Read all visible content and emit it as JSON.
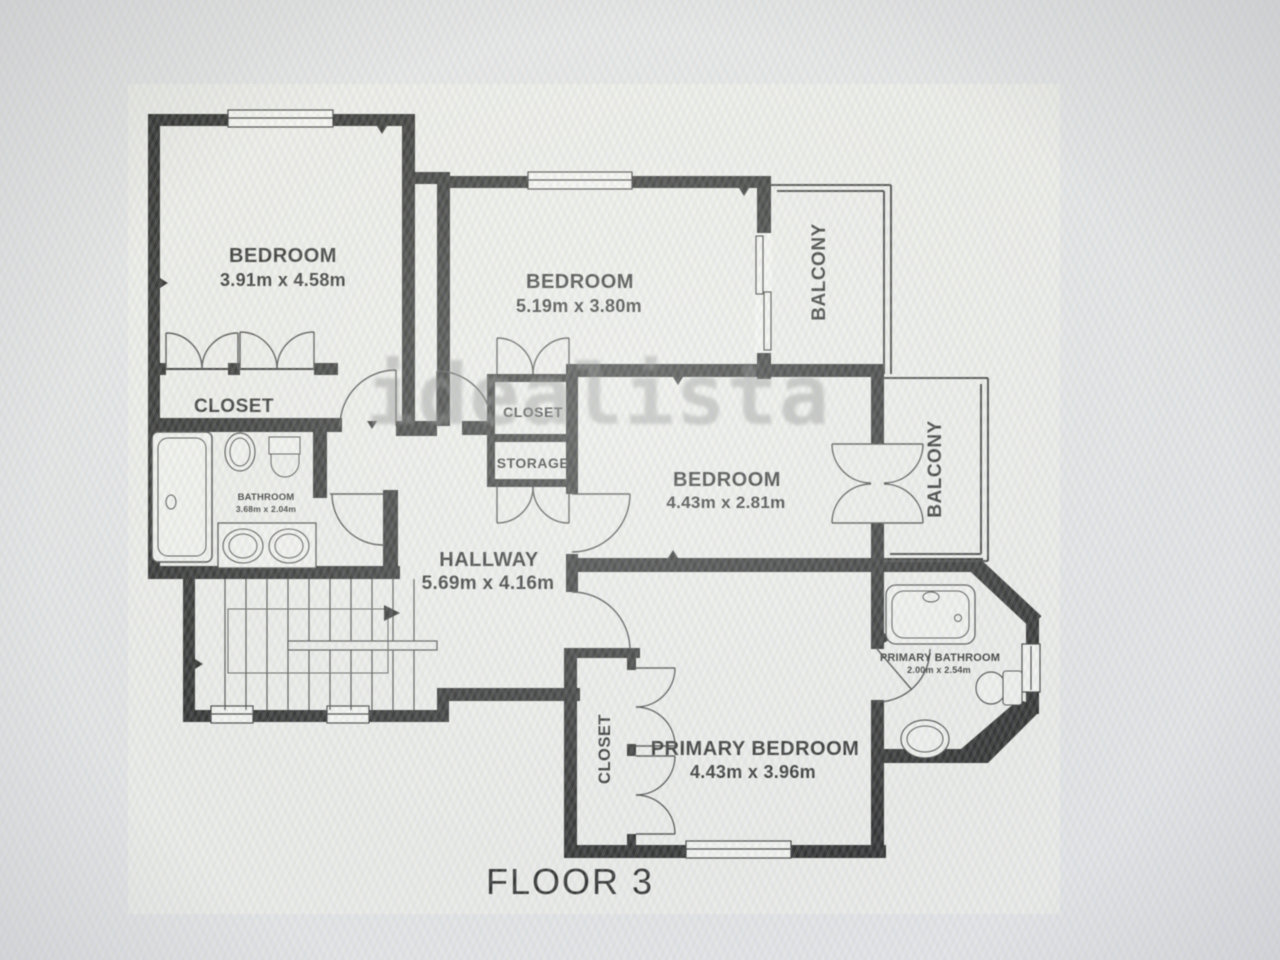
{
  "floor_label": "FLOOR 3",
  "watermark": "idealista",
  "rooms": {
    "bedroom_top_left": {
      "label": "BEDROOM",
      "dimensions": "3.91m x 4.58m"
    },
    "bedroom_top_middle": {
      "label": "BEDROOM",
      "dimensions": "5.19m x 3.80m"
    },
    "bedroom_middle_right": {
      "label": "BEDROOM",
      "dimensions": "4.43m x 2.81m"
    },
    "primary_bedroom": {
      "label": "PRIMARY BEDROOM",
      "dimensions": "4.43m x 3.96m"
    },
    "hallway": {
      "label": "HALLWAY",
      "dimensions": "5.69m x 4.16m"
    },
    "bathroom": {
      "label": "BATHROOM",
      "dimensions": "3.68m x 2.04m"
    },
    "primary_bathroom": {
      "label": "PRIMARY BATHROOM",
      "dimensions": "2.00m x 2.54m"
    },
    "closet_left": {
      "label": "CLOSET"
    },
    "closet_middle": {
      "label": "CLOSET"
    },
    "storage": {
      "label": "STORAGE"
    },
    "closet_primary": {
      "label": "CLOSET"
    },
    "balcony_top": {
      "label": "BALCONY"
    },
    "balcony_right": {
      "label": "BALCONY"
    }
  },
  "colors": {
    "wall": "#1b1b1b",
    "paper": "#f2f2ef",
    "background": "#e9eaec",
    "watermark_gray": "#6f6f6f",
    "label_text": "#1b1b1b"
  }
}
